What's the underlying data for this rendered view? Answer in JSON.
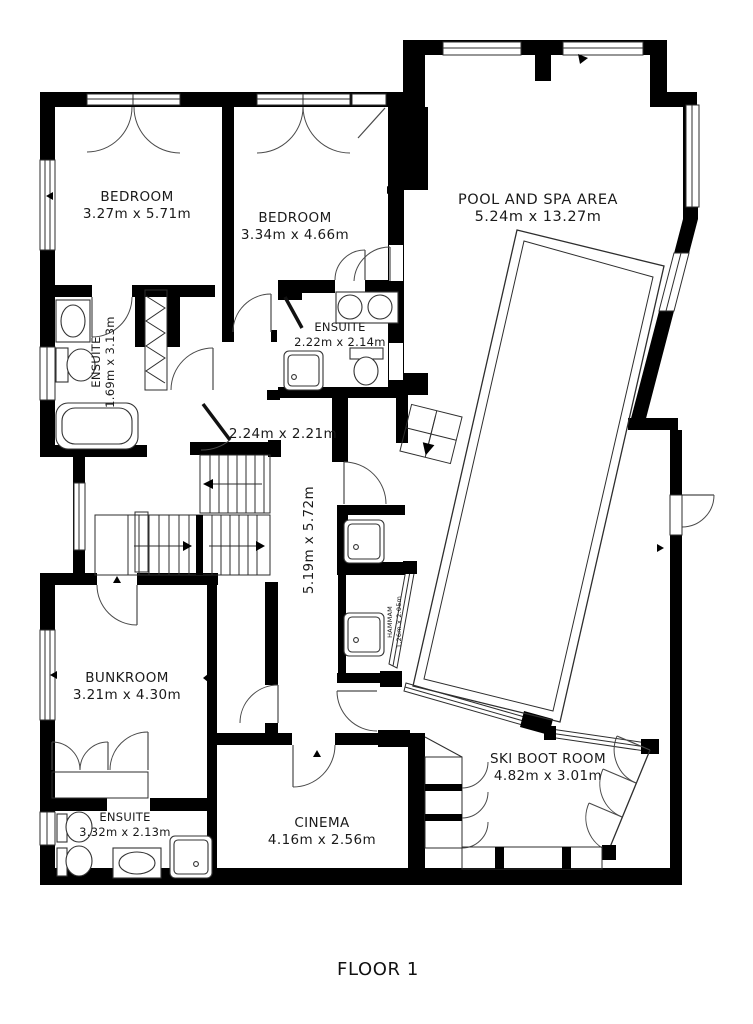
{
  "title": "FLOOR 1",
  "rooms": {
    "bedroom1": {
      "name": "BEDROOM",
      "dims": "3.27m x 5.71m"
    },
    "bedroom2": {
      "name": "BEDROOM",
      "dims": "3.34m x 4.66m"
    },
    "pool": {
      "name": "POOL AND SPA AREA",
      "dims": "5.24m x 13.27m"
    },
    "ensuite1": {
      "name": "ENSUITE",
      "dims": "1.69m x 3.13m"
    },
    "ensuite2": {
      "name": "ENSUITE",
      "dims": "2.22m x 2.14m"
    },
    "hall": {
      "dims": "2.24m x 2.21m"
    },
    "corridor": {
      "dims": "5.19m x 5.72m"
    },
    "hammam": {
      "name": "HAMMAM",
      "dims": "1.26m x 2.05m"
    },
    "bunkroom": {
      "name": "BUNKROOM",
      "dims": "3.21m x 4.30m"
    },
    "ensuite3": {
      "name": "ENSUITE",
      "dims": "3.32m x 2.13m"
    },
    "cinema": {
      "name": "CINEMA",
      "dims": "4.16m x 2.56m"
    },
    "skiboot": {
      "name": "SKI BOOT ROOM",
      "dims": "4.82m x 3.01m"
    }
  },
  "colors": {
    "wall": "#000000",
    "background": "#ffffff",
    "line": "#2e2e2e"
  }
}
